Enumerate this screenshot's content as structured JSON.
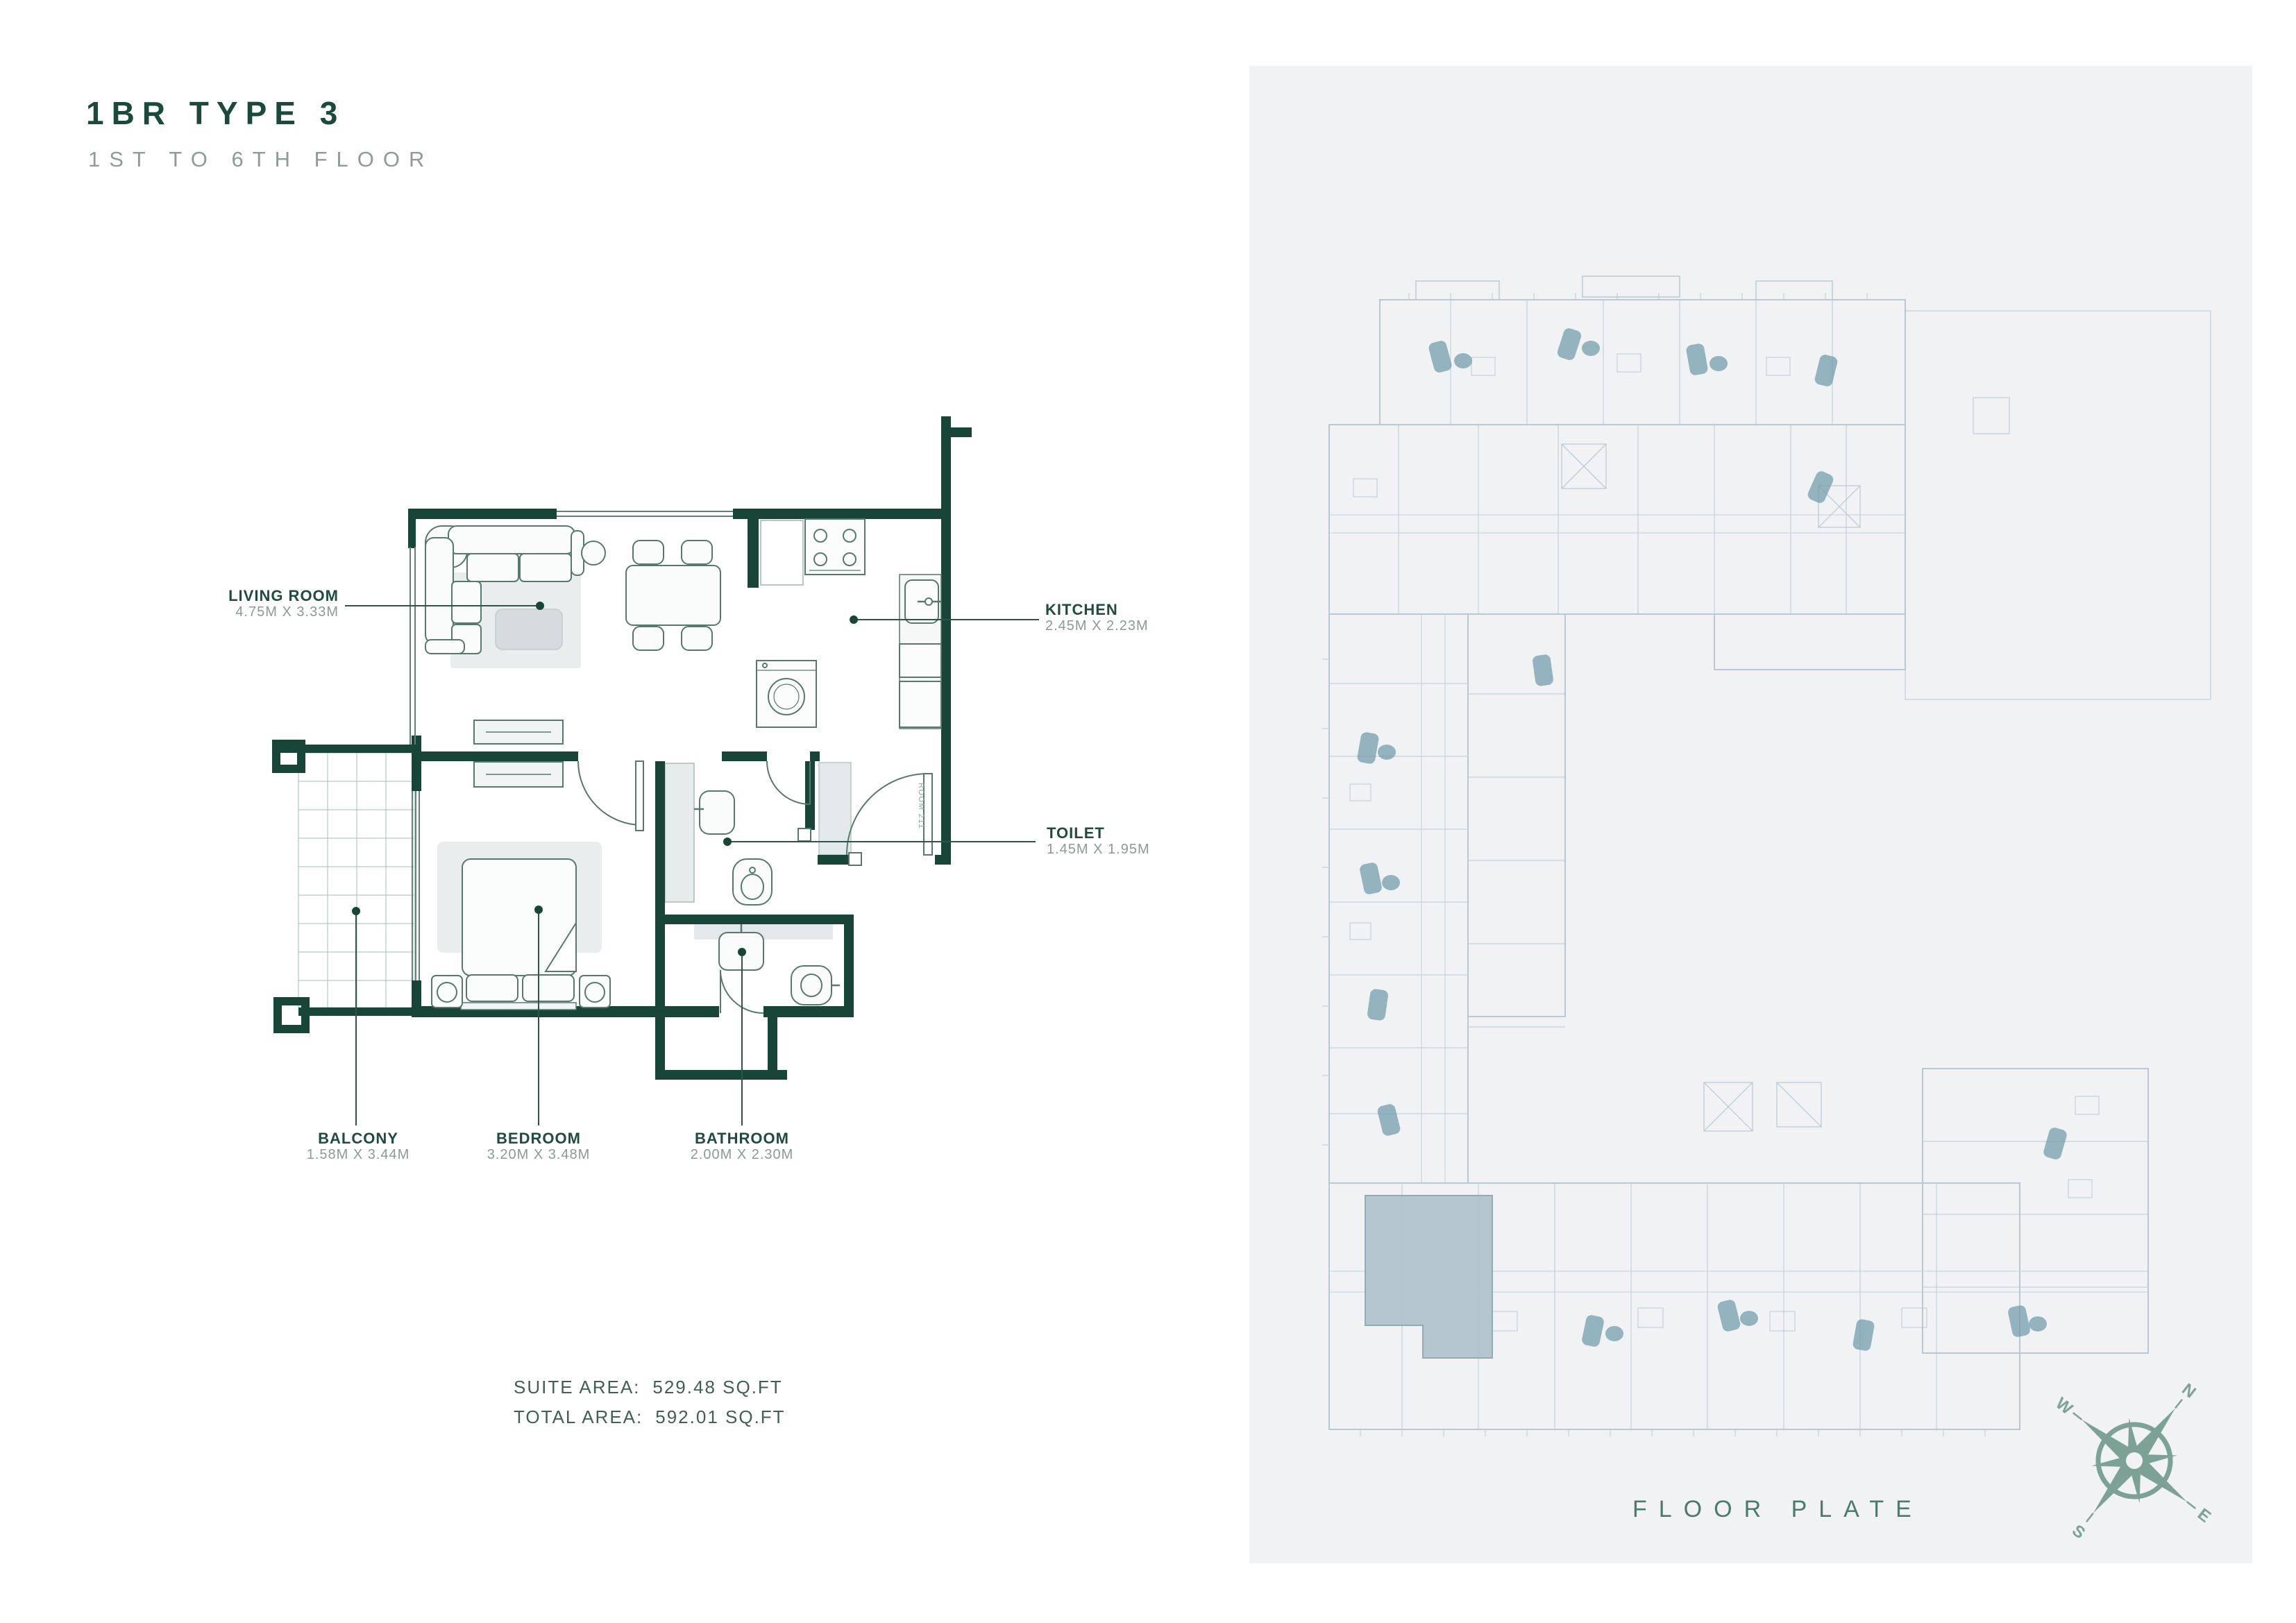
{
  "header": {
    "title": "1BR TYPE 3",
    "subtitle": "1ST TO 6TH FLOOR"
  },
  "rooms": {
    "living": {
      "name": "LIVING ROOM",
      "dims": "4.75M X 3.33M"
    },
    "kitchen": {
      "name": "KITCHEN",
      "dims": "2.45M X 2.23M"
    },
    "toilet": {
      "name": "TOILET",
      "dims": "1.45M X 1.95M"
    },
    "balcony": {
      "name": "BALCONY",
      "dims": "1.58M X 3.44M"
    },
    "bedroom": {
      "name": "BEDROOM",
      "dims": "3.20M X 3.48M"
    },
    "bathroom": {
      "name": "BATHROOM",
      "dims": "2.00M X 2.30M"
    }
  },
  "areas": {
    "suite_label": "SUITE AREA:",
    "suite_value": "529.48 SQ.FT",
    "total_label": "TOTAL AREA:",
    "total_value": "592.01 SQ.FT"
  },
  "floor_plate": {
    "caption": "FLOOR PLATE"
  },
  "compass": {
    "n": "N",
    "e": "E",
    "s": "S",
    "w": "W"
  },
  "door_label": "ROOM 211",
  "colors": {
    "wall": "#174639",
    "label_green": "#1e4c40",
    "dims_gray": "#8a9b95",
    "plate_line": "#b7cad3",
    "plate_accent": "#6f9aa9",
    "highlight": "#b0c3cb",
    "compass": "#7ba295",
    "panel_bg": "#f0f2f3"
  }
}
